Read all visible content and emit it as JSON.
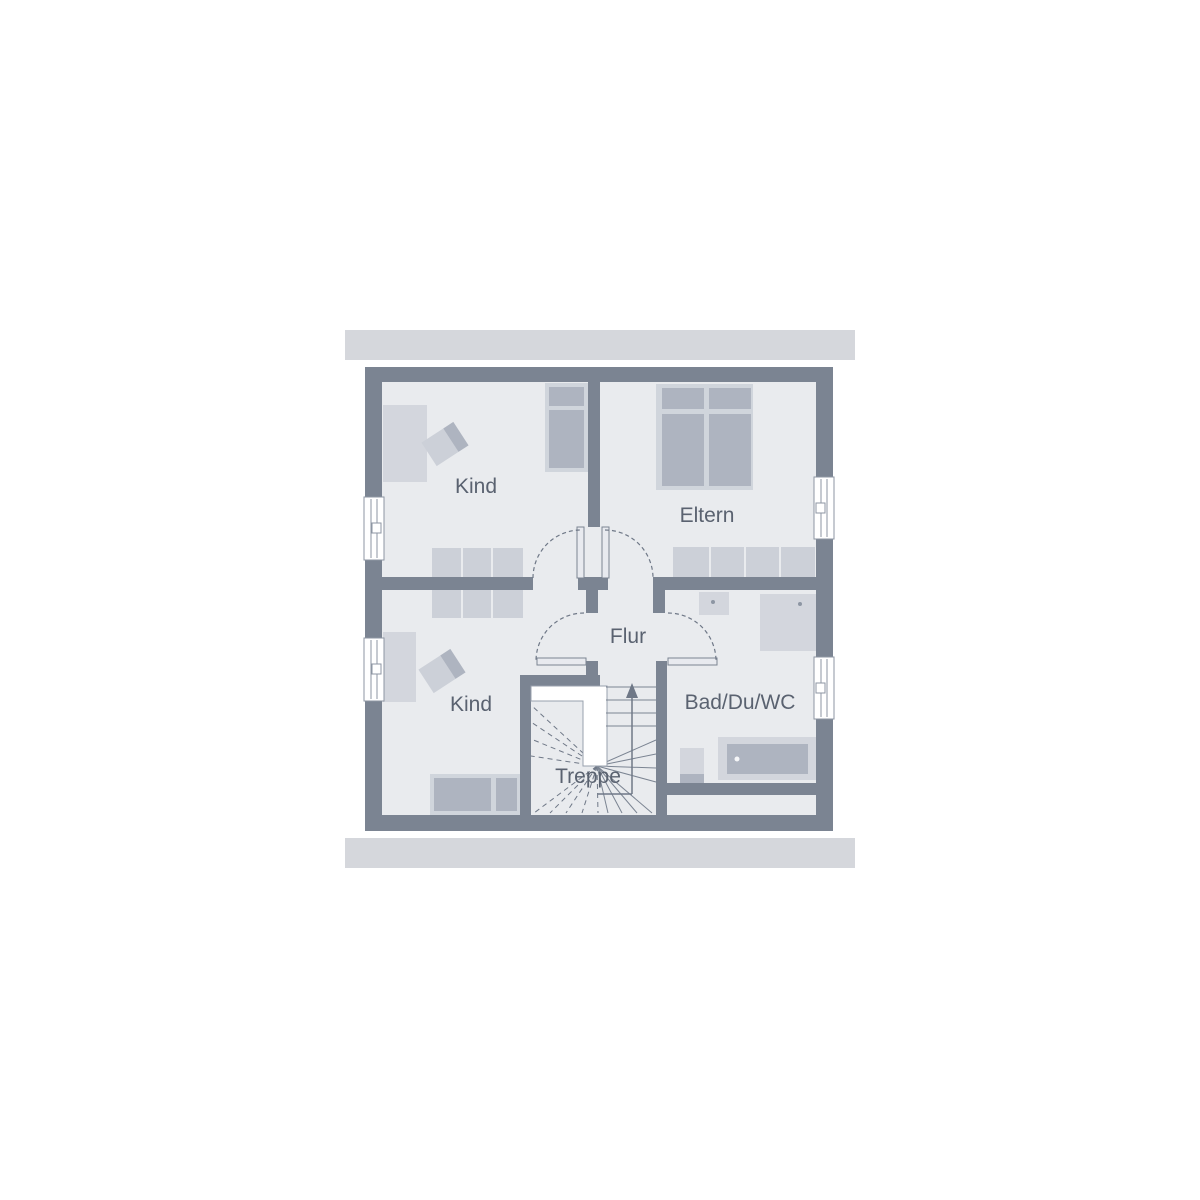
{
  "page": {
    "type": "architectural-floor-plan",
    "background": "#ffffff"
  },
  "floorplan": {
    "rooms": [
      {
        "id": "kind-top",
        "label": "Kind"
      },
      {
        "id": "eltern",
        "label": "Eltern"
      },
      {
        "id": "flur",
        "label": "Flur"
      },
      {
        "id": "kind-bottom",
        "label": "Kind"
      },
      {
        "id": "treppe",
        "label": "Treppe"
      },
      {
        "id": "bad-du-wc",
        "label": "Bad/Du/WC"
      }
    ],
    "colors": {
      "wall": "#7b8492",
      "roof_band": "#d5d7dc",
      "floor": "#e9ebee",
      "furniture_light": "#d3d6dd",
      "furniture_dark": "#aeb4c0",
      "door_swing": "#6f7887",
      "label_text": "#5a6270",
      "canvas": "#ffffff"
    }
  }
}
